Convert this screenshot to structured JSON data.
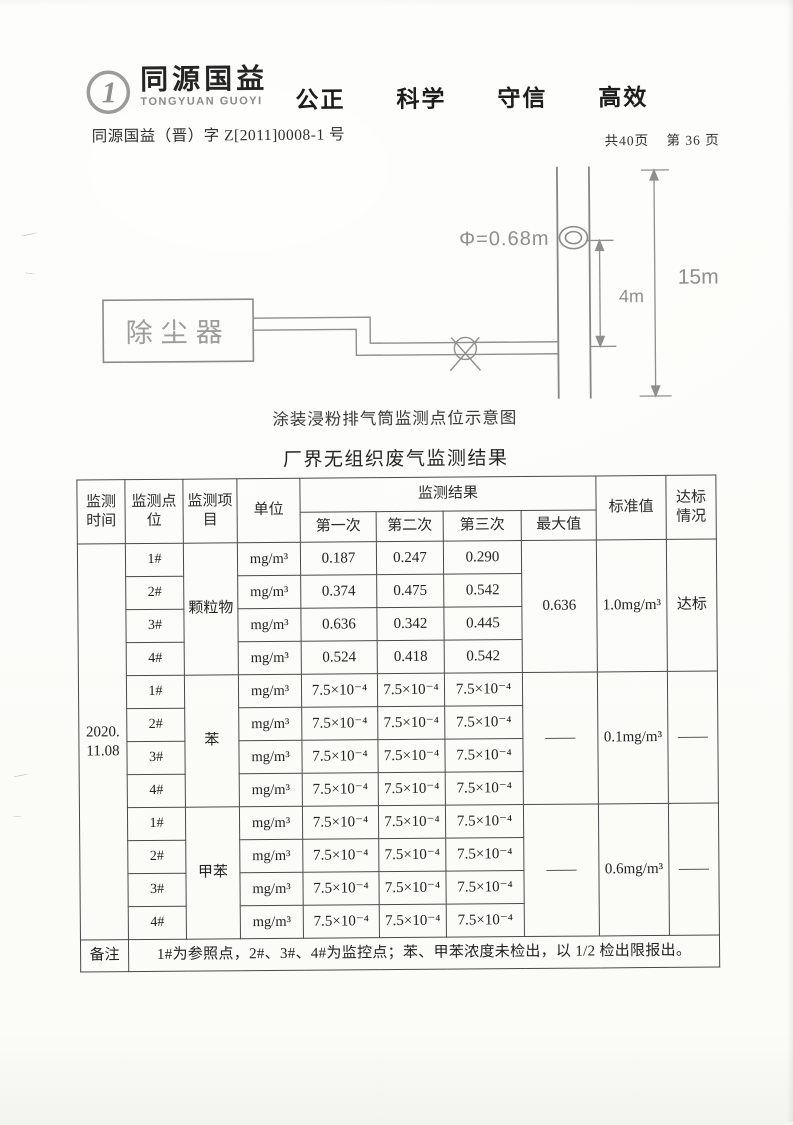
{
  "header": {
    "logo": {
      "glyph": "1",
      "name_cn": "同源国益",
      "name_en": "TONGYUAN GUOYI"
    },
    "slogans": [
      "公正",
      "科学",
      "守信",
      "高效"
    ],
    "doc_number": "同源国益（晋）字 Z[2011]0008-1 号",
    "page_total": "共40页",
    "page_current": "第 36 页"
  },
  "diagram": {
    "equipment_label": "除尘器",
    "diameter_label": "Φ=0.68m",
    "port_height_label": "4m",
    "stack_height_label": "15m",
    "caption": "涂装浸粉排气筒监测点位示意图"
  },
  "table": {
    "title": "厂界无组织废气监测结果",
    "headers": {
      "time": "监测时间",
      "point": "监测点位",
      "item": "监测项目",
      "unit": "单位",
      "results": "监测结果",
      "run1": "第一次",
      "run2": "第二次",
      "run3": "第三次",
      "max": "最大值",
      "standard": "标准值",
      "compliance": "达标情况"
    },
    "date_line1": "2020.",
    "date_line2": "11.08",
    "groups": [
      {
        "item": "颗粒物",
        "max": "0.636",
        "standard": "1.0mg/m³",
        "compliance": "达标",
        "rows": [
          {
            "point": "1#",
            "unit": "mg/m³",
            "v1": "0.187",
            "v2": "0.247",
            "v3": "0.290"
          },
          {
            "point": "2#",
            "unit": "mg/m³",
            "v1": "0.374",
            "v2": "0.475",
            "v3": "0.542"
          },
          {
            "point": "3#",
            "unit": "mg/m³",
            "v1": "0.636",
            "v2": "0.342",
            "v3": "0.445"
          },
          {
            "point": "4#",
            "unit": "mg/m³",
            "v1": "0.524",
            "v2": "0.418",
            "v3": "0.542"
          }
        ]
      },
      {
        "item": "苯",
        "max": "——",
        "standard": "0.1mg/m³",
        "compliance": "——",
        "rows": [
          {
            "point": "1#",
            "unit": "mg/m³",
            "v1": "7.5×10⁻⁴",
            "v2": "7.5×10⁻⁴",
            "v3": "7.5×10⁻⁴"
          },
          {
            "point": "2#",
            "unit": "mg/m³",
            "v1": "7.5×10⁻⁴",
            "v2": "7.5×10⁻⁴",
            "v3": "7.5×10⁻⁴"
          },
          {
            "point": "3#",
            "unit": "mg/m³",
            "v1": "7.5×10⁻⁴",
            "v2": "7.5×10⁻⁴",
            "v3": "7.5×10⁻⁴"
          },
          {
            "point": "4#",
            "unit": "mg/m³",
            "v1": "7.5×10⁻⁴",
            "v2": "7.5×10⁻⁴",
            "v3": "7.5×10⁻⁴"
          }
        ]
      },
      {
        "item": "甲苯",
        "max": "——",
        "standard": "0.6mg/m³",
        "compliance": "——",
        "rows": [
          {
            "point": "1#",
            "unit": "mg/m³",
            "v1": "7.5×10⁻⁴",
            "v2": "7.5×10⁻⁴",
            "v3": "7.5×10⁻⁴"
          },
          {
            "point": "2#",
            "unit": "mg/m³",
            "v1": "7.5×10⁻⁴",
            "v2": "7.5×10⁻⁴",
            "v3": "7.5×10⁻⁴"
          },
          {
            "point": "3#",
            "unit": "mg/m³",
            "v1": "7.5×10⁻⁴",
            "v2": "7.5×10⁻⁴",
            "v3": "7.5×10⁻⁴"
          },
          {
            "point": "4#",
            "unit": "mg/m³",
            "v1": "7.5×10⁻⁴",
            "v2": "7.5×10⁻⁴",
            "v3": "7.5×10⁻⁴"
          }
        ]
      }
    ],
    "note_label": "备注",
    "note": "1#为参照点，2#、3#、4#为监控点；苯、甲苯浓度未检出，以 1/2 检出限报出。"
  }
}
